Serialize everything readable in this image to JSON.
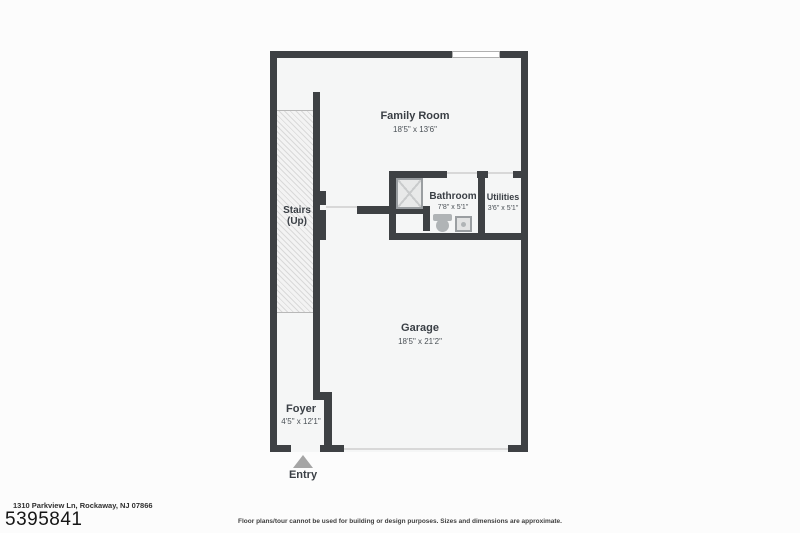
{
  "colors": {
    "wall": "#3e4144",
    "floor": "#f5f6f6",
    "background": "#fcfcfc",
    "hatch_line": "#d9d9d9",
    "door_line": "#d8d8d8",
    "fixture": "#b0b4b6",
    "entry_arrow": "#a5a5a5",
    "label": "#3a3f45"
  },
  "rooms": {
    "family_room": {
      "label": "Family Room",
      "dims": "18'5\" x 13'6\""
    },
    "stairs": {
      "label": "Stairs",
      "sublabel": "(Up)"
    },
    "bathroom": {
      "label": "Bathroom",
      "dims": "7'8\" x 5'1\""
    },
    "utilities": {
      "label": "Utilities",
      "dims": "3'6\" x 5'1\""
    },
    "garage": {
      "label": "Garage",
      "dims": "18'5\" x 21'2\""
    },
    "foyer": {
      "label": "Foyer",
      "dims": "4'5\" x 12'1\""
    },
    "entry": {
      "label": "Entry"
    }
  },
  "icons": {
    "shower": "shower-stall-x",
    "toilet": "toilet-icon",
    "sink": "sink-icon",
    "entry_arrow": "entry-arrow-icon",
    "window": "window-opening"
  },
  "footer": {
    "address": "1310 Parkview Ln, Rockaway, NJ 07866",
    "mls_number": "5395841",
    "disclaimer": "Floor plans/tour cannot be used for building or design purposes. Sizes and dimensions are approximate."
  }
}
